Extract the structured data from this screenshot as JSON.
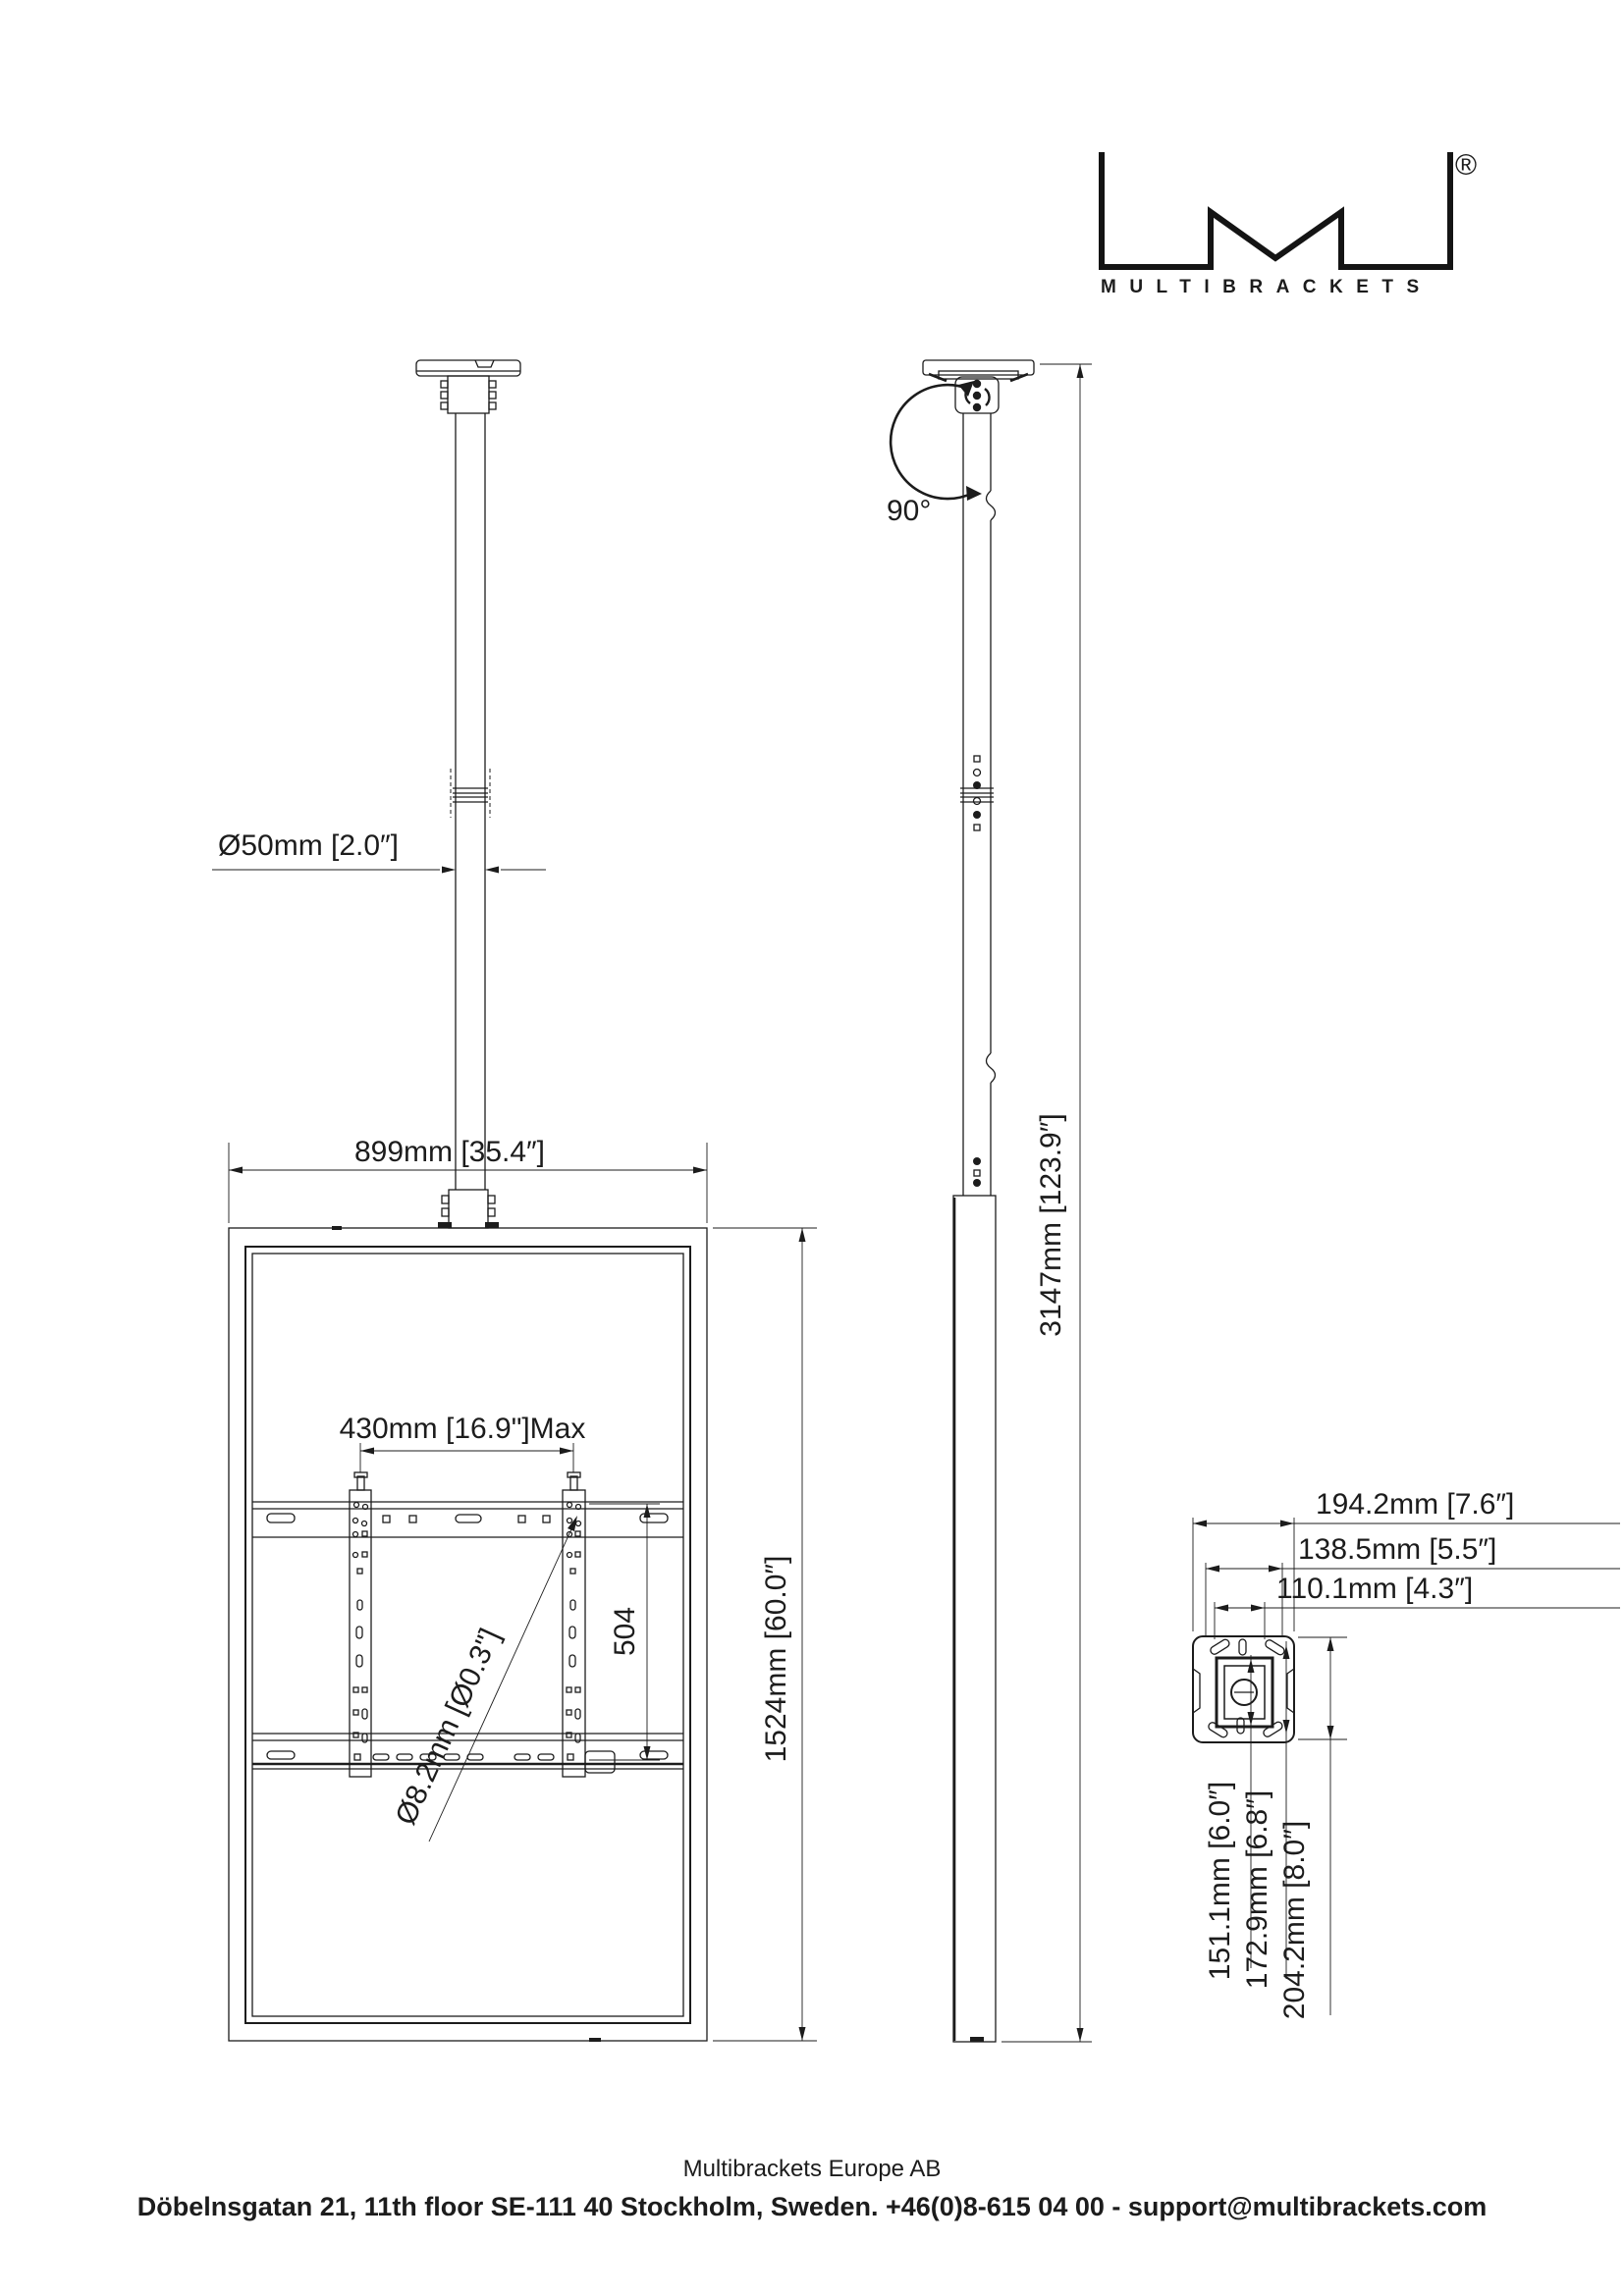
{
  "logo": {
    "wordmark": "MULTIBRACKETS",
    "registered": "®"
  },
  "front_view": {
    "pole_diameter": "Ø50mm [2.0″]",
    "width": "899mm [35.4″]",
    "bracket_width_max": "430mm [16.9\"]Max",
    "bracket_height": "504",
    "hole_diameter": "Ø8.2mm [Ø0.3\"]",
    "screen_height": "1524mm [60.0″]"
  },
  "side_view": {
    "rotation_angle": "90°",
    "total_height": "3147mm [123.9″]"
  },
  "detail_view": {
    "width_outer": "194.2mm [7.6″]",
    "width_middle": "138.5mm [5.5″]",
    "width_inner": "110.1mm [4.3″]",
    "height_inner": "151.1mm [6.0″]",
    "height_middle": "172.9mm [6.8″]",
    "height_outer": "204.2mm [8.0″]"
  },
  "footer": {
    "company": "Multibrackets Europe AB",
    "address": "Döbelnsgatan 21, 11th floor SE-111 40 Stockholm, Sweden. +46(0)8-615 04 00 - support@multibrackets.com"
  }
}
